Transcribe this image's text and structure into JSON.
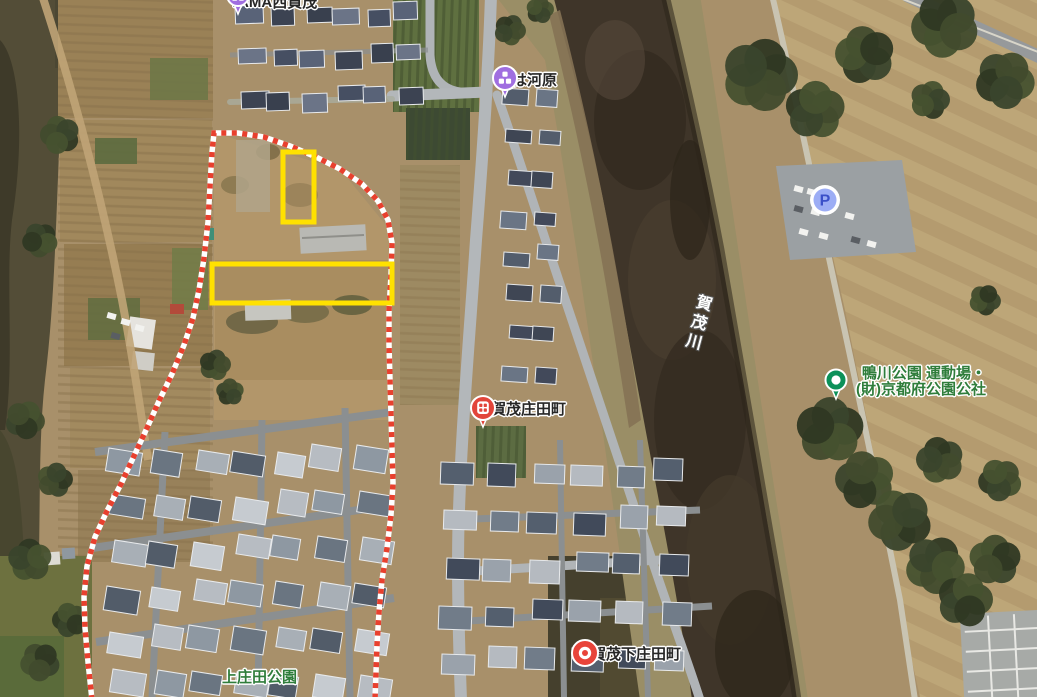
{
  "labels": {
    "tama": "TAMA西賀茂",
    "ohakawara": "おは河原",
    "river": "賀茂川",
    "bus_stop_shodacho": "西賀茂庄田町",
    "bus_stop_shimoshodacho": "西賀茂下庄田町",
    "park_kamogawa_line1": "鴨川公園 運動場・",
    "park_kamogawa_line2": "(財)京都府公園公社",
    "park_kamishoda": "上庄田公園",
    "parking_letter": "P"
  },
  "icons": {
    "tama_pin": "purple-place-pin",
    "ohakawara_pin": "purple-place-pin",
    "shodacho_pin": "red-bus-stop-pin",
    "shimoshodacho_pin": "red-spot-pin",
    "kamogawa_park_pin": "green-park-pin",
    "parking_icon": "blue-parking-circle"
  },
  "colors": {
    "annotation_yellow": "#ffe100",
    "annotation_red": "#e8402e",
    "annotation_white": "#ffffff",
    "label_green": "#2f7d3b",
    "label_black": "#262626",
    "river_label": "#ffffff",
    "pin_purple": "#a06ee0",
    "pin_red": "#e2453a",
    "pin_green": "#0c9159",
    "parking_blue": "#3b50c9",
    "parking_fill": "#9cadf5"
  },
  "annotations": {
    "boundary_points": [
      [
        92,
        700
      ],
      [
        88,
        662
      ],
      [
        85,
        628
      ],
      [
        84,
        597
      ],
      [
        87,
        566
      ],
      [
        95,
        537
      ],
      [
        107,
        511
      ],
      [
        121,
        484
      ],
      [
        134,
        456
      ],
      [
        147,
        428
      ],
      [
        159,
        401
      ],
      [
        172,
        374
      ],
      [
        184,
        345
      ],
      [
        193,
        318
      ],
      [
        199,
        290
      ],
      [
        204,
        258
      ],
      [
        208,
        222
      ],
      [
        210,
        186
      ],
      [
        212,
        152
      ],
      [
        214,
        133
      ],
      [
        238,
        133
      ],
      [
        264,
        137
      ],
      [
        290,
        146
      ],
      [
        316,
        157
      ],
      [
        340,
        169
      ],
      [
        362,
        184
      ],
      [
        378,
        201
      ],
      [
        388,
        220
      ],
      [
        392,
        243
      ],
      [
        391,
        275
      ],
      [
        389,
        310
      ],
      [
        389,
        345
      ],
      [
        390,
        380
      ],
      [
        391,
        415
      ],
      [
        392,
        450
      ],
      [
        393,
        483
      ],
      [
        391,
        515
      ],
      [
        387,
        548
      ],
      [
        382,
        580
      ],
      [
        379,
        612
      ],
      [
        377,
        645
      ],
      [
        376,
        672
      ],
      [
        375,
        700
      ]
    ],
    "highlight_rects": [
      {
        "x": 283,
        "y": 152,
        "w": 31,
        "h": 70
      },
      {
        "x": 212,
        "y": 264,
        "w": 180,
        "h": 39
      }
    ]
  }
}
